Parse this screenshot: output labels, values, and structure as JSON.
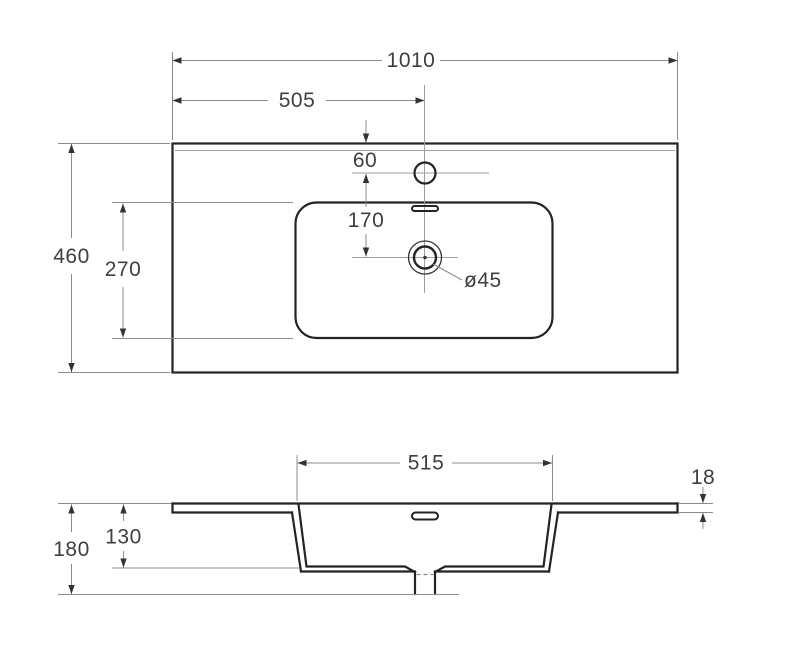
{
  "drawing": {
    "type": "technical-dimension-drawing",
    "subject": "vanity washbasin top view and front section view",
    "colors": {
      "background": "#ffffff",
      "outline": "#232323",
      "dimension_lines": "#8c8c8c",
      "labels": "#3f3f3f"
    },
    "dims": {
      "top_view": {
        "overall_width": "1010",
        "faucet_center_from_left": "505",
        "faucet_from_back_edge": "60",
        "faucet_to_drain": "170",
        "basin_front_back": "270",
        "overall_depth": "460",
        "drain_diameter": "ø45"
      },
      "section_view": {
        "basin_width": "515",
        "countertop_thickness": "18",
        "basin_depth": "130",
        "overall_height": "180"
      }
    }
  }
}
